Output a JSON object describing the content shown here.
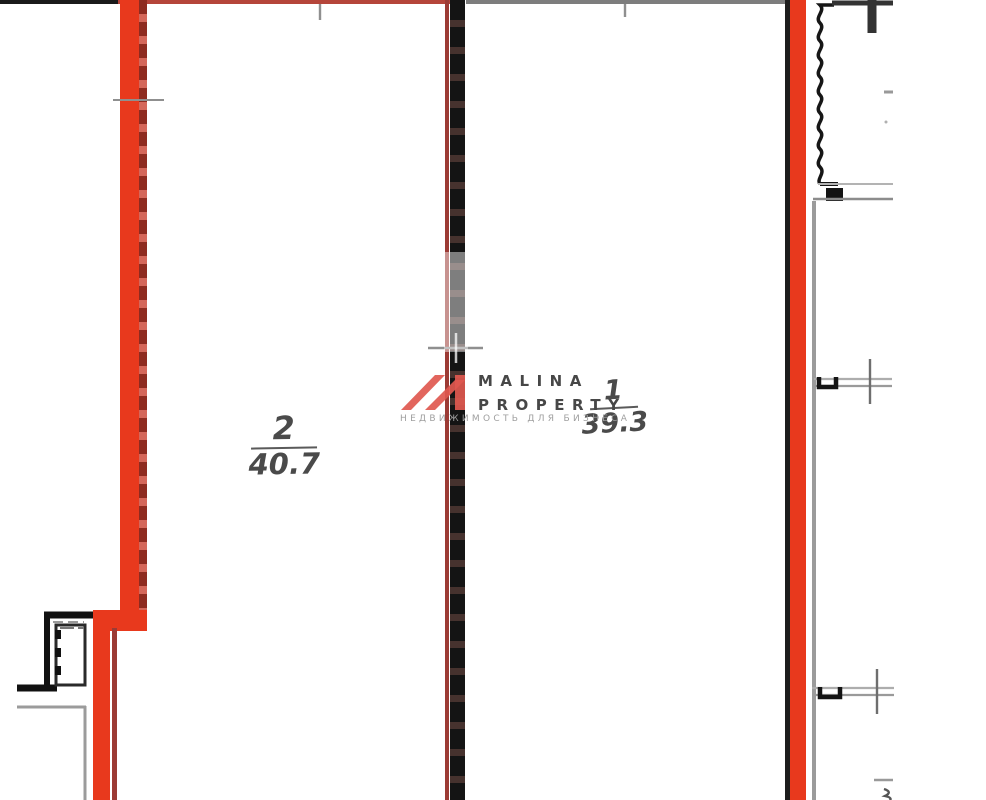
{
  "plan": {
    "rooms": [
      {
        "number": "2",
        "area": "40.7"
      },
      {
        "number": "1",
        "area": "39.3"
      }
    ]
  },
  "watermark": {
    "brand_line1": "MALINA",
    "brand_line2": "PROPERTY",
    "tagline": "НЕДВИЖИМОСТЬ ДЛЯ БИЗНЕСА"
  },
  "colors": {
    "highlight_red": "#e8391d",
    "muted_red_line": "#b5453a",
    "maroon_line": "#9c3b35",
    "wall_black": "#1a1a1a",
    "line_gray": "#7d7d7d",
    "facade_gray": "#9b9b9b",
    "logo_red": "#e0584f",
    "label_gray": "#4a4a4a"
  }
}
